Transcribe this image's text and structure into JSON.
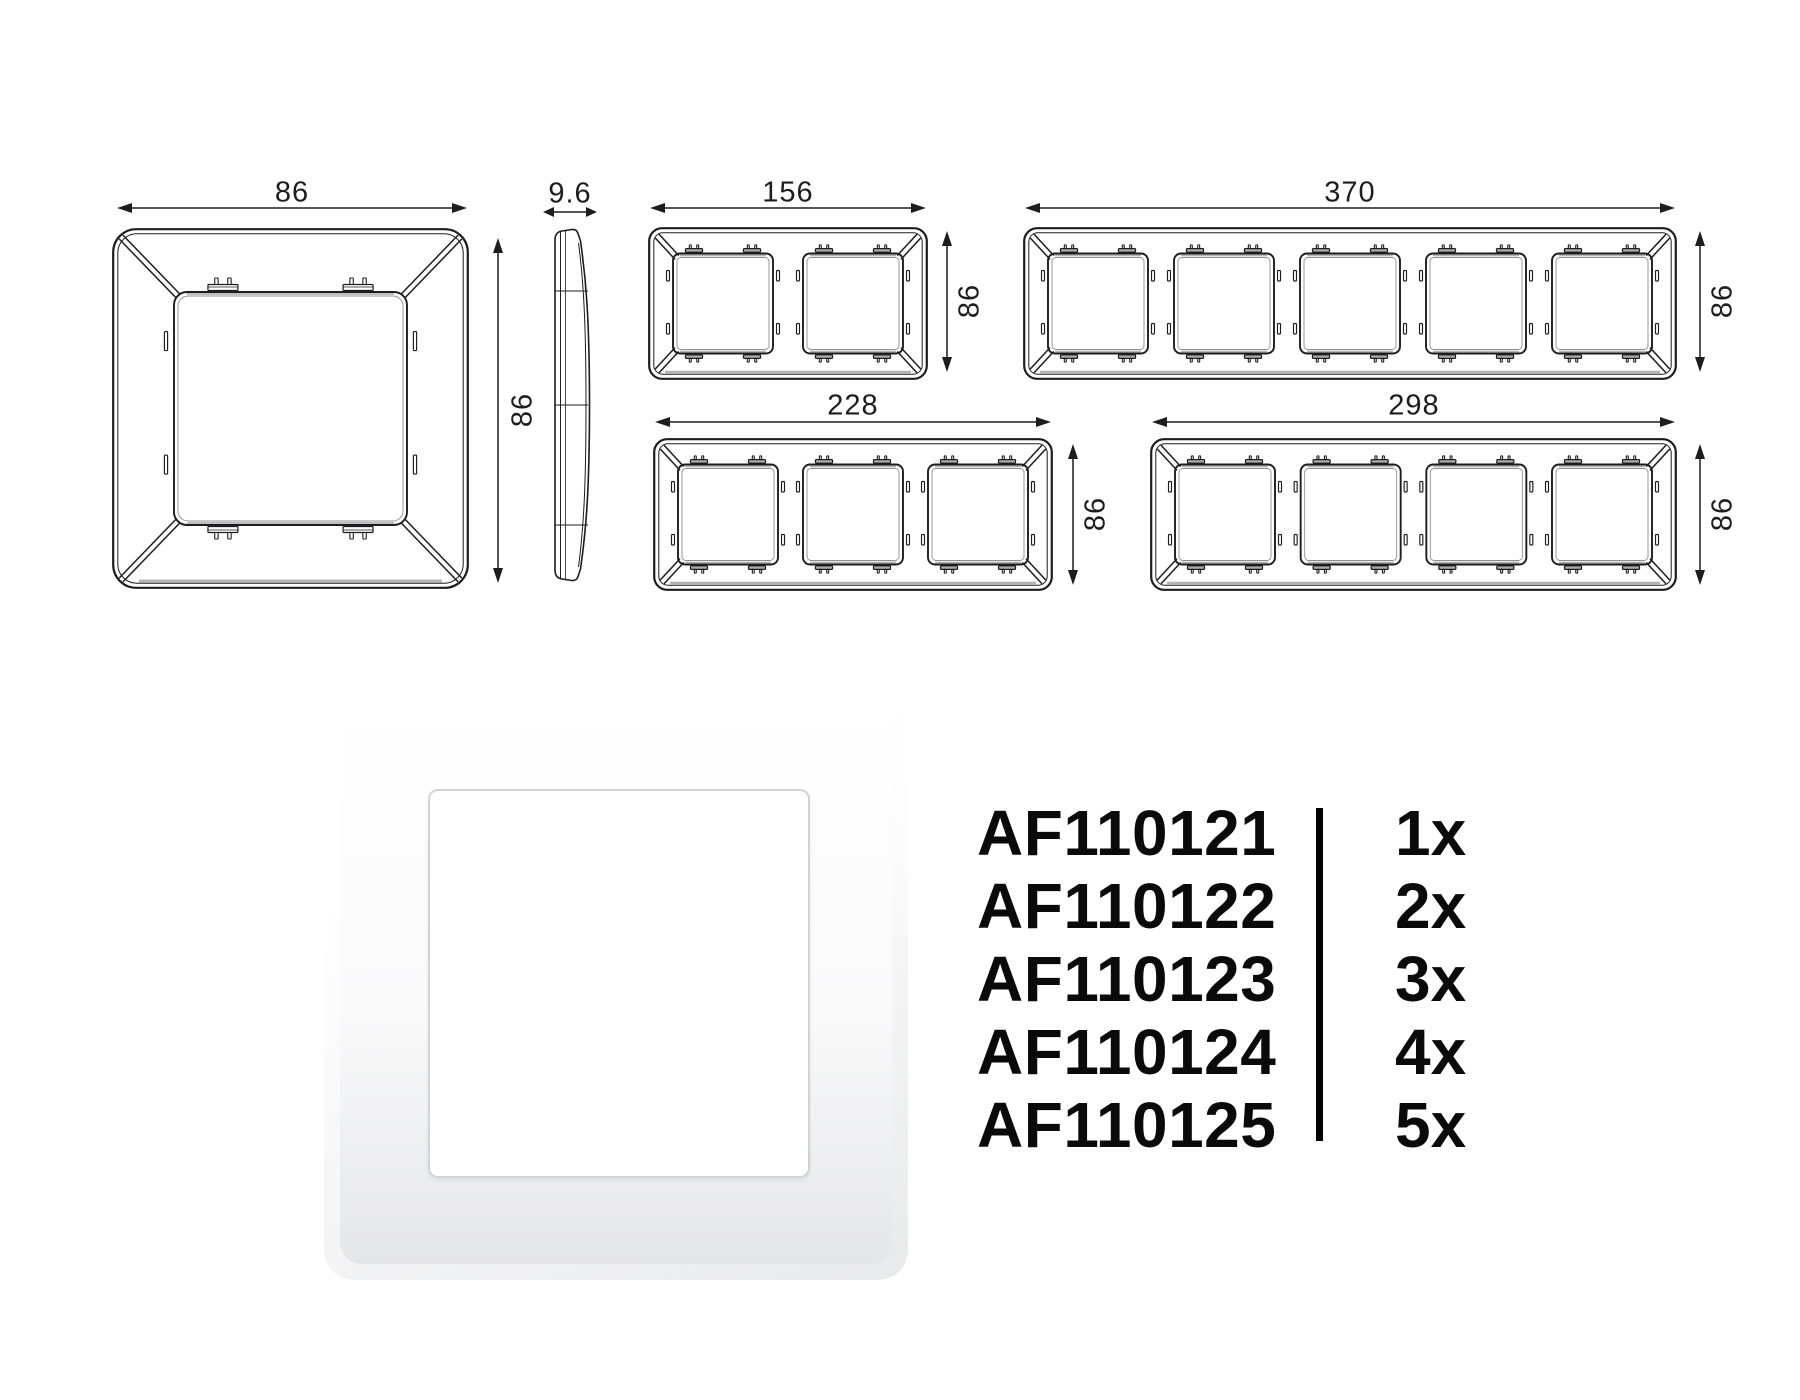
{
  "dimensions": {
    "single_width": "86",
    "single_height": "86",
    "profile_depth": "9.6",
    "gang2_width": "156",
    "gang2_height": "86",
    "gang3_width": "228",
    "gang3_height": "86",
    "gang4_width": "298",
    "gang4_height": "86",
    "gang5_width": "370",
    "gang5_height": "86"
  },
  "product_table": {
    "rows": [
      {
        "code": "AF110121",
        "qty": "1x"
      },
      {
        "code": "AF110122",
        "qty": "2x"
      },
      {
        "code": "AF110123",
        "qty": "3x"
      },
      {
        "code": "AF110124",
        "qty": "4x"
      },
      {
        "code": "AF110125",
        "qty": "5x"
      }
    ]
  },
  "colors": {
    "line": "#1d1d1f",
    "text": "#0a0a0a",
    "background": "#ffffff"
  }
}
